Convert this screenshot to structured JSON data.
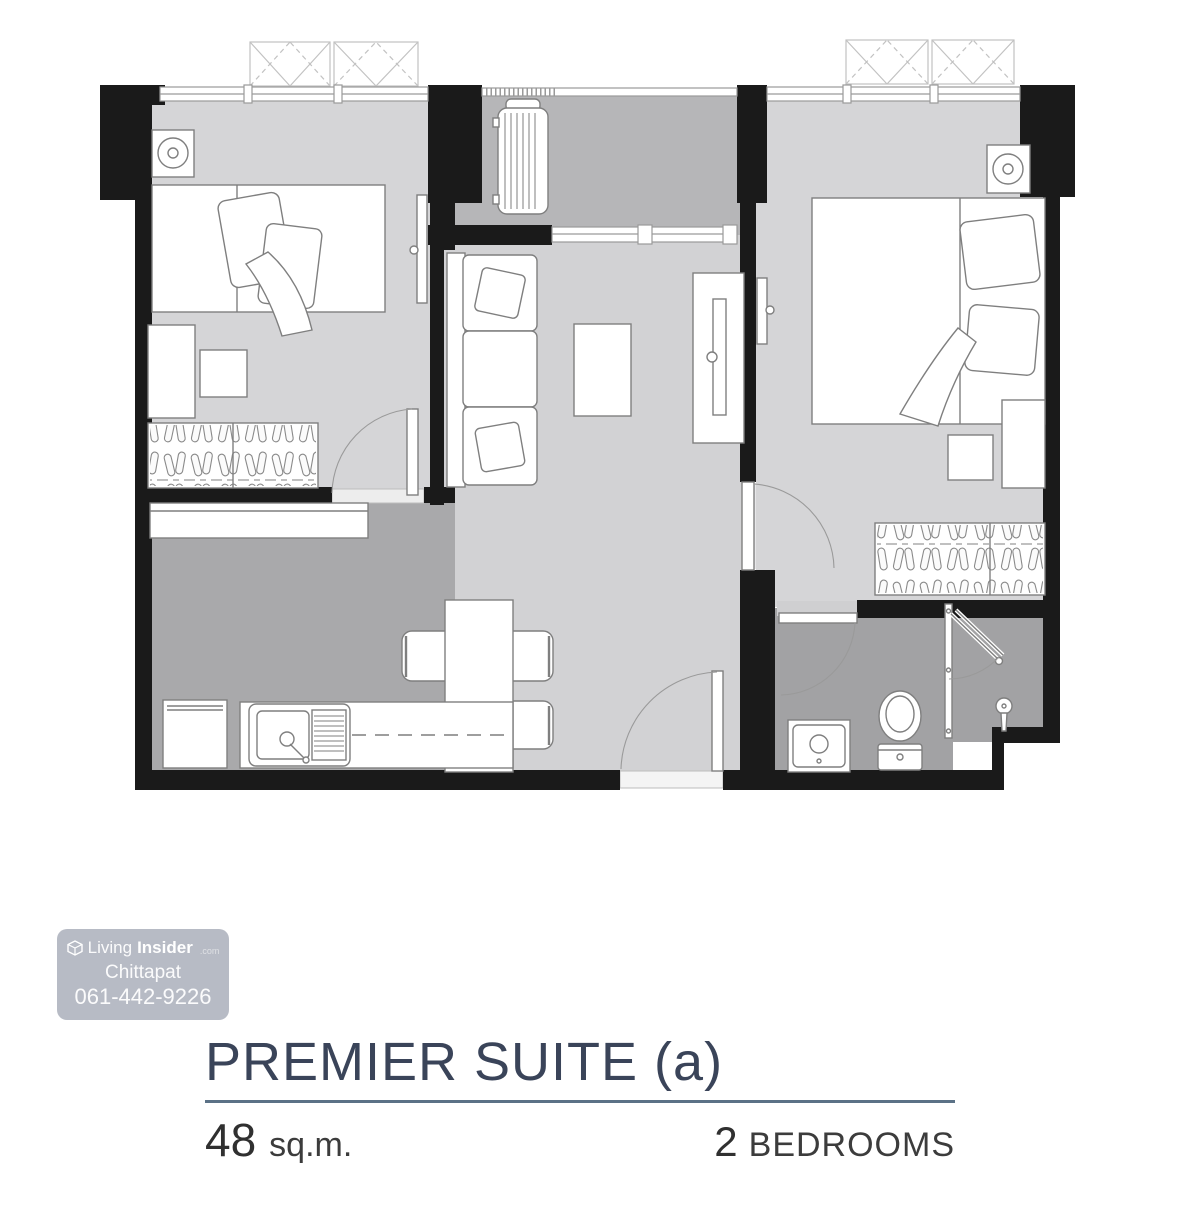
{
  "title_block": {
    "title": "PREMIER SUITE (a)",
    "area_value": "48",
    "area_unit": "sq.m.",
    "bedroom_count": "2",
    "bedroom_label": "BEDROOMS"
  },
  "watermark": {
    "brand_prefix": "Living",
    "brand_suffix": "Insider",
    "brand_domain": ".com",
    "agent_name": "Chittapat",
    "phone": "061-442-9226"
  },
  "colors": {
    "title_navy": "#3a4459",
    "rule_blue": "#5b7186",
    "text_dark": "#333333",
    "wall_black": "#1a1a1a",
    "floor_light": "#d5d5d7",
    "floor_balcony": "#b6b6b8",
    "floor_kitchen": "#a9a9ab",
    "floor_bathroom": "#a2a2a4",
    "watermark_bg": "#b1b5c0",
    "watermark_text": "#ffffff"
  }
}
